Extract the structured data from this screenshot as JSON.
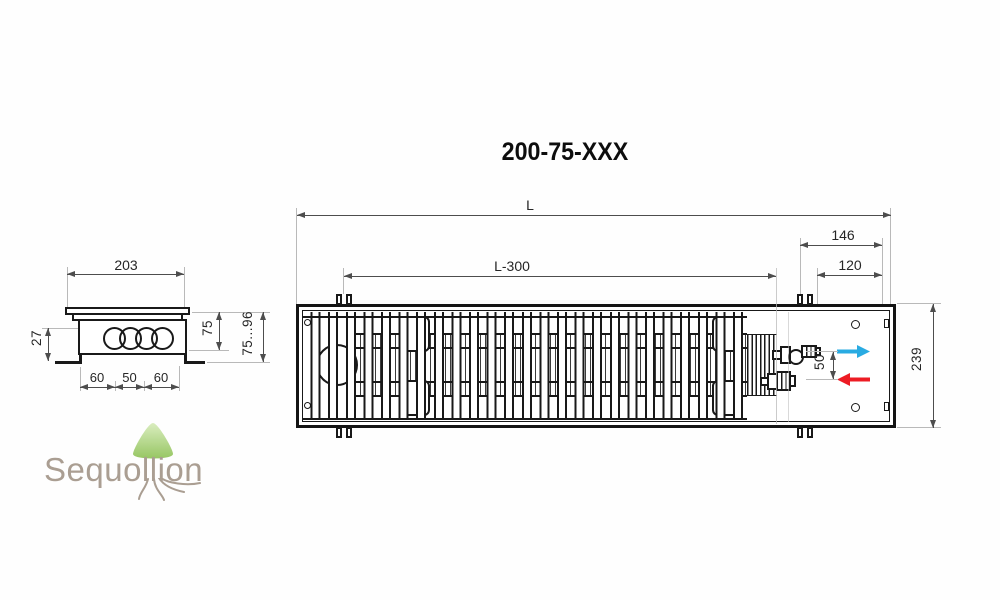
{
  "title": "200-75-XXX",
  "top_view": {
    "dim_length": "L",
    "dim_grille_length": "L-300",
    "dim_end_section": "146",
    "dim_end_inner": "120",
    "dim_pipe_spacing": "50",
    "dim_depth": "239"
  },
  "side_view": {
    "dim_width": "203",
    "dim_bottom_offset": "27",
    "dim_tube_left": "60",
    "dim_tube_mid": "50",
    "dim_tube_right": "60",
    "dim_casing_height": "75",
    "dim_total_height": "75...96"
  },
  "watermark": {
    "brand": "Sequollion"
  },
  "colors": {
    "flow_supply_arrow": "#29abe2",
    "flow_return_arrow": "#ed1c24",
    "leaf_top": "#d7ecba",
    "leaf_bottom": "#8fc257",
    "logo_text": "#a39689"
  }
}
